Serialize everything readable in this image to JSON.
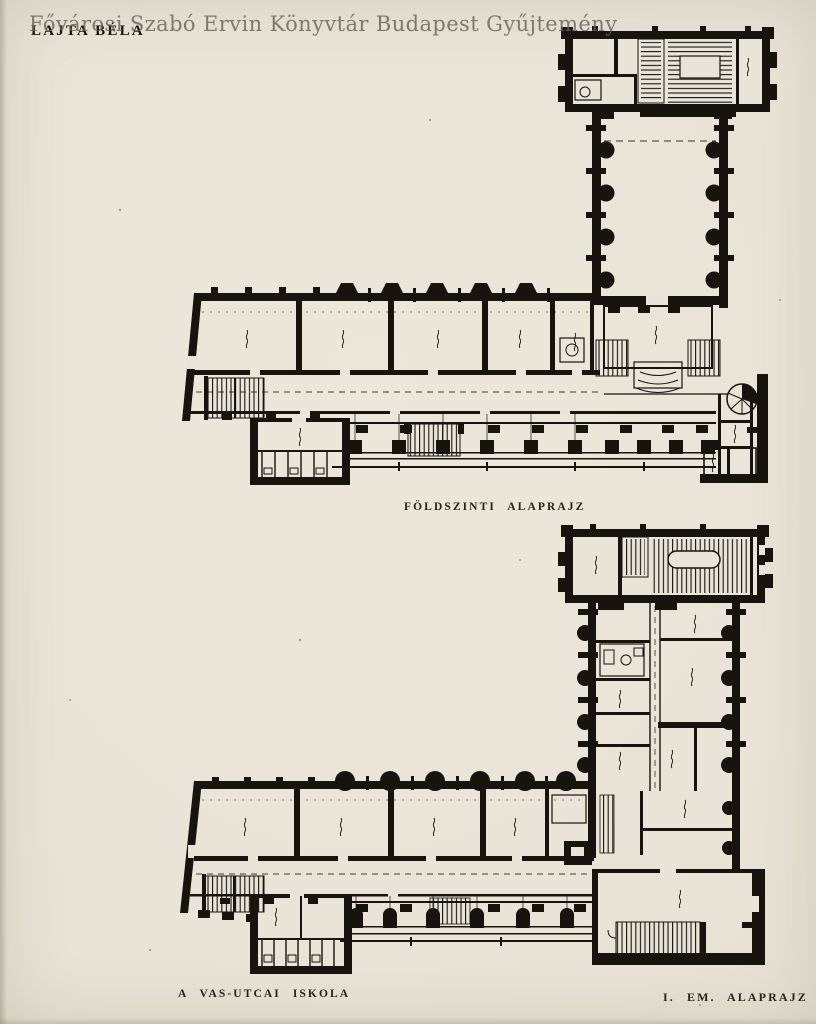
{
  "page": {
    "watermark_text": "Fővárosi Szabó Ervin Könyvtár Budapest Gyűjtemény",
    "author_stamp": "LAJTA BÉLA",
    "captions": {
      "ground_floor": "FÖLDSZINTI ALAPRAJZ",
      "building_name": "A VAS-UTCAI ISKOLA",
      "first_floor": "I. EM. ALAPRAJZ"
    },
    "colors": {
      "paper": "#e9e4d7",
      "ink": "#17130e",
      "watermark_gray": "#686356"
    }
  }
}
